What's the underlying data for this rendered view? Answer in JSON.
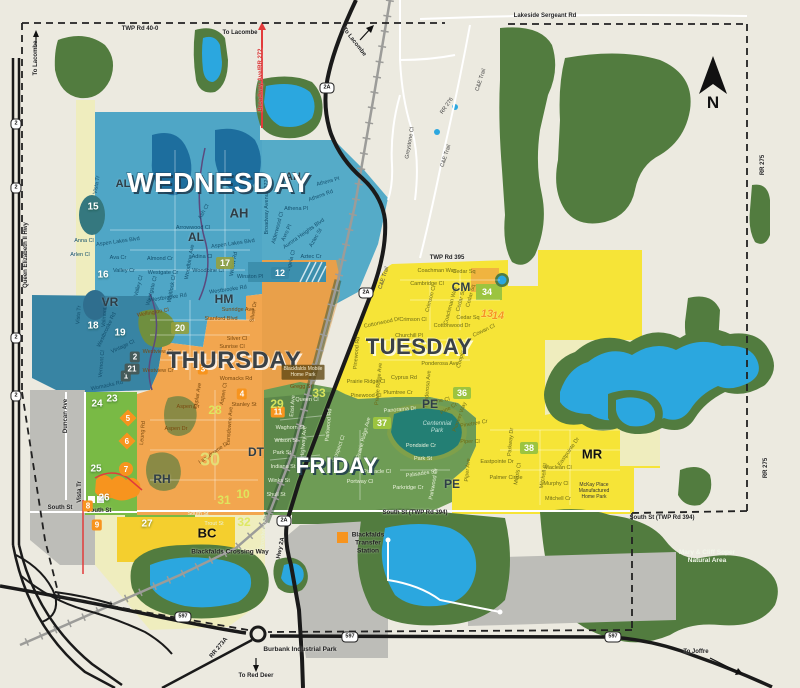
{
  "map": {
    "days": [
      {
        "label": "WEDNESDAY",
        "x": 219,
        "y": 183,
        "style": "light",
        "size": 28
      },
      {
        "label": "THURSDAY",
        "x": 234,
        "y": 361,
        "style": "dark",
        "size": 24
      },
      {
        "label": "TUESDAY",
        "x": 419,
        "y": 347,
        "style": "dark",
        "size": 22
      },
      {
        "label": "FRIDAY",
        "x": 337,
        "y": 466,
        "style": "light",
        "size": 22
      }
    ],
    "districts": [
      {
        "code": "AL",
        "x": 123,
        "y": 184,
        "size": 11
      },
      {
        "code": "AL",
        "x": 196,
        "y": 237,
        "size": 12
      },
      {
        "code": "AH",
        "x": 293,
        "y": 177,
        "size": 11
      },
      {
        "code": "AH",
        "x": 239,
        "y": 213,
        "size": 13
      },
      {
        "code": "VR",
        "x": 110,
        "y": 302,
        "size": 12
      },
      {
        "code": "HM",
        "x": 224,
        "y": 299,
        "size": 12
      },
      {
        "code": "DT",
        "x": 256,
        "y": 452,
        "size": 12
      },
      {
        "code": "RH",
        "x": 162,
        "y": 479,
        "size": 12
      },
      {
        "code": "PE",
        "x": 430,
        "y": 404,
        "size": 12
      },
      {
        "code": "PE",
        "x": 452,
        "y": 484,
        "size": 12
      },
      {
        "code": "CM",
        "x": 461,
        "y": 287,
        "size": 12
      },
      {
        "code": "MR",
        "x": 592,
        "y": 454,
        "size": 13,
        "big": true
      },
      {
        "code": "BC",
        "x": 207,
        "y": 533,
        "size": 13,
        "big": true
      }
    ],
    "markers": [
      {
        "n": "1",
        "x": 126,
        "y": 376,
        "v": "s"
      },
      {
        "n": "2",
        "x": 135,
        "y": 357,
        "v": "s"
      },
      {
        "n": "21",
        "x": 132,
        "y": 369,
        "v": "s"
      },
      {
        "n": "3",
        "x": 203,
        "y": 369,
        "v": "r"
      },
      {
        "n": "4",
        "x": 242,
        "y": 394,
        "v": "r"
      },
      {
        "n": "8",
        "x": 88,
        "y": 506,
        "v": "r"
      },
      {
        "n": "9",
        "x": 97,
        "y": 525,
        "v": "r"
      },
      {
        "n": "11",
        "x": 278,
        "y": 412,
        "v": "r"
      },
      {
        "n": "5",
        "x": 128,
        "y": 418,
        "v": "dm"
      },
      {
        "n": "6",
        "x": 127,
        "y": 441,
        "v": "dm"
      },
      {
        "n": "7",
        "x": 126,
        "y": 469,
        "v": "ci"
      },
      {
        "n": "12",
        "x": 280,
        "y": 273,
        "v": "tb"
      },
      {
        "n": "15",
        "x": 93,
        "y": 207,
        "v": "p"
      },
      {
        "n": "16",
        "x": 103,
        "y": 275,
        "v": "p"
      },
      {
        "n": "18",
        "x": 93,
        "y": 326,
        "v": "p"
      },
      {
        "n": "19",
        "x": 120,
        "y": 333,
        "v": "p"
      },
      {
        "n": "17",
        "x": 225,
        "y": 263,
        "v": "ob"
      },
      {
        "n": "20",
        "x": 180,
        "y": 328,
        "v": "ob"
      },
      {
        "n": "23",
        "x": 112,
        "y": 399,
        "v": "p"
      },
      {
        "n": "24",
        "x": 97,
        "y": 404,
        "v": "p"
      },
      {
        "n": "25",
        "x": 96,
        "y": 469,
        "v": "p"
      },
      {
        "n": "26",
        "x": 104,
        "y": 498,
        "v": "p"
      },
      {
        "n": "27",
        "x": 147,
        "y": 524,
        "v": "p"
      },
      {
        "n": "34",
        "x": 487,
        "y": 292,
        "v": "gb"
      },
      {
        "n": "36",
        "x": 462,
        "y": 393,
        "v": "gb"
      },
      {
        "n": "37",
        "x": 382,
        "y": 423,
        "v": "gb"
      },
      {
        "n": "38",
        "x": 529,
        "y": 448,
        "v": "gb"
      },
      {
        "n": "28",
        "x": 215,
        "y": 410,
        "v": "w"
      },
      {
        "n": "29",
        "x": 277,
        "y": 404,
        "v": "w"
      },
      {
        "n": "31",
        "x": 224,
        "y": 500,
        "v": "w"
      },
      {
        "n": "32",
        "x": 244,
        "y": 522,
        "v": "w"
      },
      {
        "n": "33",
        "x": 319,
        "y": 393,
        "v": "w"
      },
      {
        "n": "10",
        "x": 243,
        "y": 494,
        "v": "w"
      },
      {
        "n": "30",
        "x": 210,
        "y": 460,
        "v": "Wb"
      },
      {
        "n": "13",
        "x": 487,
        "y": 314,
        "v": "i"
      },
      {
        "n": "14",
        "x": 498,
        "y": 316,
        "v": "i"
      }
    ],
    "streets": [
      [
        "Vista Tr",
        97,
        185,
        -80,
        "b"
      ],
      [
        "Anna Cl",
        84,
        241,
        0,
        "b"
      ],
      [
        "Aspen Lakes Blvd",
        118,
        242,
        -8,
        "b"
      ],
      [
        "Arlen Cl",
        80,
        255,
        0,
        "b"
      ],
      [
        "Ava Cr",
        118,
        258,
        0,
        "b"
      ],
      [
        "Valley Cr",
        124,
        271,
        0,
        "b"
      ],
      [
        "Valley Cl",
        139,
        286,
        -75,
        "b"
      ],
      [
        "Almond Cr",
        160,
        259,
        0,
        "b"
      ],
      [
        "Westgate Cr",
        163,
        273,
        0,
        "b"
      ],
      [
        "Westgate Cl",
        152,
        291,
        -75,
        "b"
      ],
      [
        "Whitlock Cl",
        172,
        289,
        -80,
        "b"
      ],
      [
        "Westbrooke Rd",
        168,
        298,
        -8,
        "b"
      ],
      [
        "Aspen Lakes Blvd",
        233,
        244,
        -8,
        "b"
      ],
      [
        "Arrowwood Cl",
        193,
        228,
        0,
        "b"
      ],
      [
        "Ash Cl",
        204,
        212,
        -60,
        "b"
      ],
      [
        "Adina Cl",
        202,
        257,
        0,
        "b"
      ],
      [
        "Woodbine Ave",
        190,
        262,
        -80,
        "b"
      ],
      [
        "Woodbine Cl",
        208,
        271,
        0,
        "b"
      ],
      [
        "Willow Rd",
        234,
        264,
        -80,
        "b"
      ],
      [
        "Winston Pl",
        250,
        277,
        0,
        "b"
      ],
      [
        "Westbrooke Rd",
        228,
        290,
        -8,
        "b"
      ],
      [
        "Athens Pl",
        328,
        182,
        -15,
        "b"
      ],
      [
        "Athens Rd",
        321,
        196,
        -20,
        "b"
      ],
      [
        "Athena Pl",
        296,
        209,
        0,
        "b"
      ],
      [
        "Alderwood Cl",
        278,
        228,
        -75,
        "b"
      ],
      [
        "Avro Pl",
        287,
        233,
        -65,
        "b"
      ],
      [
        "Aurora Heights Blvd",
        304,
        234,
        -35,
        "b"
      ],
      [
        "Aztec St",
        316,
        238,
        -60,
        "b"
      ],
      [
        "Aztec Cr",
        311,
        257,
        0,
        "b"
      ],
      [
        "Angela Cl",
        291,
        262,
        -75,
        "b"
      ],
      [
        "Broadway Avenue 272",
        267,
        207,
        -90,
        "b"
      ],
      [
        "Valmont St",
        105,
        314,
        -85,
        "b"
      ],
      [
        "Vista Tr",
        79,
        315,
        -85,
        "b"
      ],
      [
        "Westbrooke Rd",
        107,
        330,
        -65,
        "b"
      ],
      [
        "Vintage Cl",
        123,
        347,
        -25,
        "b"
      ],
      [
        "Vermont Cl",
        102,
        364,
        -85,
        "b"
      ],
      [
        "Womacks Rd",
        107,
        386,
        -12,
        "b"
      ],
      [
        "Wellington Cl",
        153,
        313,
        -10,
        "o"
      ],
      [
        "Sunridge Ave",
        238,
        310,
        0,
        "o"
      ],
      [
        "Stanford Blvd",
        221,
        319,
        0,
        "o"
      ],
      [
        "Silver Dr",
        254,
        312,
        -80,
        "o"
      ],
      [
        "Silver Cl",
        237,
        339,
        0,
        "o"
      ],
      [
        "Sunrise Cl",
        232,
        347,
        0,
        "o"
      ],
      [
        "Westview Cr",
        158,
        352,
        0,
        "o"
      ],
      [
        "Westview Cr",
        158,
        371,
        0,
        "o"
      ],
      [
        "Womacks Rd",
        236,
        379,
        0,
        "o"
      ],
      [
        "Gregg St",
        301,
        387,
        0,
        "o"
      ],
      [
        "Stanley St",
        244,
        405,
        0,
        "o"
      ],
      [
        "Aspen Dr",
        188,
        407,
        0,
        "o"
      ],
      [
        "Aspen Dr",
        176,
        429,
        0,
        "o"
      ],
      [
        "Poplar Ave",
        198,
        396,
        -80,
        "o"
      ],
      [
        "Aspen Cl",
        224,
        394,
        -80,
        "o"
      ],
      [
        "Lansdowne Ave",
        230,
        426,
        -85,
        "o"
      ],
      [
        "Lansdowne Dr",
        214,
        453,
        -35,
        "o"
      ],
      [
        "Leung Rd",
        143,
        433,
        -85,
        "o"
      ],
      [
        "Waghorn St",
        290,
        428,
        0,
        "g"
      ],
      [
        "Wilson St",
        286,
        441,
        0,
        "g"
      ],
      [
        "Park St",
        282,
        453,
        0,
        "g"
      ],
      [
        "Indiana St",
        283,
        467,
        0,
        "g"
      ],
      [
        "Winks St",
        279,
        481,
        0,
        "g"
      ],
      [
        "Shull St",
        276,
        495,
        0,
        "g"
      ],
      [
        "East Ave",
        293,
        406,
        -85,
        "g"
      ],
      [
        "Queen Cl",
        307,
        400,
        0,
        "g"
      ],
      [
        "Highway Ave",
        304,
        442,
        -85,
        "g"
      ],
      [
        "Broadway Ave",
        264,
        531,
        -85,
        "g"
      ],
      [
        "Trout St",
        214,
        524,
        0,
        "g"
      ],
      [
        "South St",
        198,
        514,
        0,
        "g"
      ],
      [
        "Parkwood Rd",
        329,
        425,
        -85,
        "g"
      ],
      [
        "Prospect Cl",
        339,
        449,
        -70,
        "g"
      ],
      [
        "Prairie Ridge Ave",
        364,
        438,
        -75,
        "g"
      ],
      [
        "Panorama Dr",
        400,
        410,
        -5,
        "g"
      ],
      [
        "Pondside Cr",
        421,
        446,
        0,
        "g"
      ],
      [
        "Park St",
        423,
        459,
        0,
        "g"
      ],
      [
        "Pinnacle Cl",
        377,
        472,
        0,
        "g"
      ],
      [
        "Palisades St",
        421,
        474,
        -8,
        "g"
      ],
      [
        "Parkridge Cr",
        408,
        488,
        0,
        "g"
      ],
      [
        "Portway Cl",
        360,
        482,
        0,
        "g"
      ],
      [
        "Parkwood Cr",
        434,
        484,
        -80,
        "g"
      ],
      [
        "Coachman Way",
        437,
        271,
        0,
        "d"
      ],
      [
        "Cedar Sq",
        464,
        272,
        0,
        "d"
      ],
      [
        "Cambridge Cl",
        427,
        284,
        0,
        "d"
      ],
      [
        "Crimson Cl",
        431,
        299,
        -75,
        "d"
      ],
      [
        "Crimson Cl",
        413,
        320,
        0,
        "d"
      ],
      [
        "Coachman Way",
        451,
        306,
        -75,
        "d"
      ],
      [
        "Cedar St",
        461,
        301,
        -75,
        "d"
      ],
      [
        "Cedar Sq",
        471,
        296,
        -75,
        "d"
      ],
      [
        "Cedar Sq",
        468,
        318,
        0,
        "d"
      ],
      [
        "Cottonwood Dr",
        382,
        323,
        -12,
        "d"
      ],
      [
        "Cottonwood Dr",
        452,
        326,
        0,
        "d"
      ],
      [
        "Churchill Pl",
        409,
        336,
        0,
        "d"
      ],
      [
        "Cowan Cl",
        484,
        331,
        -25,
        "d"
      ],
      [
        "Cooper Cl",
        462,
        356,
        -75,
        "d"
      ],
      [
        "Ponderosa Ave",
        440,
        364,
        0,
        "d"
      ],
      [
        "Ponderosa Ave",
        428,
        389,
        -85,
        "d"
      ],
      [
        "Cyprus Rd",
        404,
        378,
        0,
        "d"
      ],
      [
        "Plumtree Cr",
        398,
        393,
        0,
        "d"
      ],
      [
        "Pine Cl",
        441,
        401,
        -10,
        "d"
      ],
      [
        "Pine Cr",
        449,
        409,
        -30,
        "d"
      ],
      [
        "Pinewood Rd",
        357,
        353,
        -85,
        "d"
      ],
      [
        "Prairie Ridge Cl",
        366,
        382,
        0,
        "d"
      ],
      [
        "Prairie Ridge Ave",
        379,
        384,
        -85,
        "d"
      ],
      [
        "Pinewood Cl",
        366,
        396,
        0,
        "d"
      ],
      [
        "Pinetree Cr",
        474,
        424,
        -10,
        "d"
      ],
      [
        "Piper Cl",
        470,
        442,
        0,
        "d"
      ],
      [
        "Piper Ave",
        468,
        470,
        -85,
        "d"
      ],
      [
        "Parkway Dr",
        511,
        442,
        -85,
        "d"
      ],
      [
        "Eastpointe Dr",
        497,
        462,
        0,
        "d"
      ],
      [
        "Eastpointe Dr",
        569,
        452,
        -55,
        "d"
      ],
      [
        "Morris Cl",
        518,
        474,
        -80,
        "d"
      ],
      [
        "Mitchell Cl",
        544,
        476,
        -80,
        "d"
      ],
      [
        "Maclean Cl",
        558,
        468,
        0,
        "d"
      ],
      [
        "Murphy Cl",
        556,
        484,
        0,
        "d"
      ],
      [
        "Mitchell Cr",
        558,
        499,
        0,
        "d"
      ],
      [
        "Palmer Circle",
        506,
        478,
        0,
        "d"
      ],
      [
        "Pioneer Way",
        460,
        417,
        -70,
        "d"
      ],
      [
        "C&E Trail",
        481,
        80,
        -72,
        "k"
      ],
      [
        "RR 276",
        447,
        106,
        -55,
        "k"
      ],
      [
        "Greystone Cl",
        410,
        143,
        -80,
        "k"
      ],
      [
        "C&E Trail",
        446,
        156,
        -72,
        "k"
      ],
      [
        "C&E Trail",
        384,
        278,
        -72,
        "k"
      ]
    ],
    "road_labels": [
      {
        "t": "TWP Rd 40-0",
        "x": 140,
        "y": 29
      },
      {
        "t": "Lakeside Sergeant Rd",
        "x": 545,
        "y": 16
      },
      {
        "t": "To Lacombe",
        "x": 36,
        "y": 58,
        "r": -90
      },
      {
        "t": "To Lacombe",
        "x": 240,
        "y": 33
      },
      {
        "t": "To Lacombe",
        "x": 354,
        "y": 42,
        "r": 52
      },
      {
        "t": "Broadway Ave/RR 272",
        "x": 261,
        "y": 80,
        "r": -90,
        "c": "red"
      },
      {
        "t": "Queen Elizabeth II Hwy",
        "x": 26,
        "y": 255,
        "r": -90
      },
      {
        "t": "TWP Rd 395",
        "x": 447,
        "y": 258
      },
      {
        "t": "RR 275",
        "x": 763,
        "y": 165,
        "r": -90
      },
      {
        "t": "RR 275",
        "x": 766,
        "y": 468,
        "r": -90
      },
      {
        "t": "South St",
        "x": 60,
        "y": 508
      },
      {
        "t": "South St",
        "x": 99,
        "y": 511
      },
      {
        "t": "South St (TWP Rd 394)",
        "x": 415,
        "y": 513
      },
      {
        "t": "South St (TWP Rd 394)",
        "x": 662,
        "y": 518
      },
      {
        "t": "Hwy 2A",
        "x": 281,
        "y": 548,
        "r": -78
      },
      {
        "t": "RR 273A",
        "x": 219,
        "y": 648,
        "r": -50
      },
      {
        "t": "To Red Deer",
        "x": 256,
        "y": 676
      },
      {
        "t": "To Joffre",
        "x": 696,
        "y": 652
      },
      {
        "t": "Duncan Ave",
        "x": 66,
        "y": 416,
        "r": -90
      },
      {
        "t": "Vista Tr",
        "x": 80,
        "y": 492,
        "r": -90
      },
      {
        "t": "Blackfalds Crossing Way",
        "x": 230,
        "y": 552,
        "c": "bold"
      }
    ],
    "shields": [
      {
        "t": "2",
        "x": 16,
        "y": 124
      },
      {
        "t": "2",
        "x": 16,
        "y": 188
      },
      {
        "t": "2",
        "x": 16,
        "y": 338
      },
      {
        "t": "2",
        "x": 16,
        "y": 396
      },
      {
        "t": "2A",
        "x": 327,
        "y": 88
      },
      {
        "t": "2A",
        "x": 366,
        "y": 293
      },
      {
        "t": "2A",
        "x": 284,
        "y": 521
      },
      {
        "t": "597",
        "x": 183,
        "y": 617
      },
      {
        "t": "597",
        "x": 350,
        "y": 637
      },
      {
        "t": "597",
        "x": 613,
        "y": 637
      }
    ],
    "pois": [
      {
        "lines": [
          "Burbank Industrial Park"
        ],
        "x": 300,
        "y": 650,
        "cls": "poi-bold"
      },
      {
        "lines": [
          "Blackfalds",
          "Transfer",
          "Station"
        ],
        "x": 368,
        "y": 543,
        "cls": "poi-bold"
      },
      {
        "lines": [
          "Mary & Cliff Soper",
          "Natural Area"
        ],
        "x": 707,
        "y": 557,
        "cls": "poi-light"
      },
      {
        "lines": [
          "Centennial",
          "Park"
        ],
        "x": 437,
        "y": 428,
        "cls": "poi-park"
      },
      {
        "lines": [
          "McKay Place",
          "Manufactured",
          "Home Park"
        ],
        "x": 594,
        "y": 491,
        "cls": "poi-tiny"
      },
      {
        "lines": [
          "Blackfalds Mobile",
          "Home Park"
        ],
        "x": 303,
        "y": 372,
        "cls": "poi-tag"
      }
    ],
    "compass": {
      "letter": "N",
      "x": 713,
      "y": 103
    },
    "colors": {
      "wednesday": "#4FA6C6",
      "thursday": "#F2A64F",
      "tuesday": "#F6E437",
      "friday": "#6E9C55",
      "pale_zone": "#EFEDBE",
      "bright_green_zone": "#79BA45",
      "forest": "#527C3F",
      "water": "#2BA7DF",
      "industrial_gray": "#BDBDB8",
      "marker_orange": "#F7941E",
      "road_red": "#E23B3B",
      "background": "#ECEAE0"
    }
  }
}
